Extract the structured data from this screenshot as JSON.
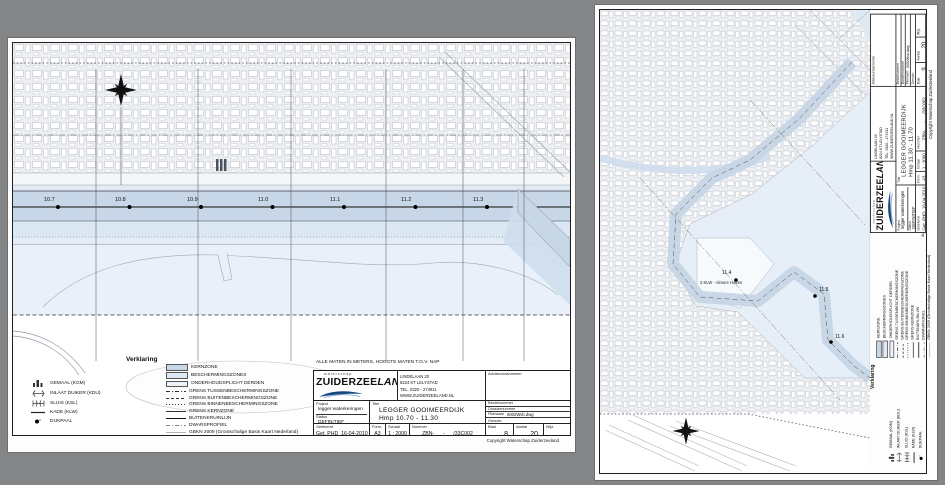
{
  "shared": {
    "note": "ALLE MATEN IN METERS, HOOGTE MATEN T.O.V. NAP",
    "copyright": "Copyright Waterschap Zuiderzeeland",
    "legend": {
      "title": "Verklaring",
      "symbols": [
        {
          "icon": "gemaal-icon",
          "label": "GEMAAL (KGM)"
        },
        {
          "icon": "inlaat-duiker-icon",
          "label": "INLAAT DUIKER (KDU)"
        },
        {
          "icon": "sluis-icon",
          "label": "SLUIS (KSL)"
        },
        {
          "icon": "kade-line-icon",
          "label": "KADE (KLW)"
        },
        {
          "icon": "dijkpaal-dot-icon",
          "label": "DIJKPAAL"
        }
      ],
      "zones": [
        {
          "label": "KERNZONE",
          "swatch": "#c8d7e7"
        },
        {
          "label": "BESCHERMINGSZONES",
          "swatch": "#dfe9f4"
        },
        {
          "label": "ONDERHOUDSPLICHT DERDEN",
          "swatch": "#eef3f9"
        },
        {
          "label": "GRENS TUSSENBESCHERMINGSZONE",
          "swatch": "dash-dot"
        },
        {
          "label": "GRENS BUITENBESCHERMINGSZONE",
          "swatch": "dashed"
        },
        {
          "label": "GRENS BINNENBESCHERMINGSZONE",
          "swatch": "dotted"
        },
        {
          "label": "GRENS KERNZONE",
          "swatch": "solid"
        },
        {
          "label": "BUITENKRUINLIJN",
          "swatch": "solid-thin"
        },
        {
          "label": "DWARSPROFIEL",
          "swatch": "dash-dot-gray"
        },
        {
          "label": "GBKN 2009 (Grootschalige Basis Kaart Nederland)",
          "swatch": "solid-gray"
        }
      ]
    },
    "company": {
      "tagline": "waterschap",
      "name_main": "ZUIDERZEE",
      "name_suffix": "LAND",
      "address": [
        "LINDELAAN 20",
        "8224 KT LELYSTAD",
        "TEL. 0320 - 274911",
        "WWW.ZUIDERZEELAND.NL"
      ]
    },
    "fields": {
      "adviseur_label": "Adviseur/aannemer",
      "project_label": "Project",
      "project_value": "legger waterkeringen",
      "status_label": "Status",
      "status_value": "DEFINITIEF",
      "titel_label": "Titel",
      "getekend_label": "Getekend",
      "getekend_value": "Get.  PHD",
      "date_value": "16-04-2010",
      "form_label": "Form.",
      "form_value": "A3",
      "schaal_label": "Schaal",
      "schaal_value": "1 : 2000",
      "nummer_label": "Nummer",
      "bestelnummer_label": "Bestelnummer",
      "dossiernummer_label": "Dossiernummer",
      "filenaam_label": "Filenaam",
      "filenaam_value": "0002Wvb.dwg",
      "omschr_label": "Omschr.",
      "blad_label": "Blad",
      "aantal_label": "Aantal",
      "aantal_value": "20",
      "wijz_label": "Wijz."
    },
    "colors": {
      "kernzone": "#c8d7e7",
      "beschermingszone": "#dfe9f4",
      "water": "#e9f0f9",
      "urban": "#edeff3",
      "logo_blue": "#16477e"
    }
  },
  "sheet_left": {
    "title_lines": [
      "LEGGER GOOIMEERDIJK",
      "Hmp 10.70 - 11.30",
      "KAARTBLAD ZBN-08"
    ],
    "nummer_value": "ZBN-      -      /33C002",
    "blad_value": "8",
    "dijkpalen": [
      "10.7",
      "10.8",
      "10.9",
      "11.0",
      "11.1",
      "11.2",
      "11.3"
    ]
  },
  "sheet_right": {
    "title_lines": [
      "LEGGER GOOIMEERDIJK",
      "Hmp 11.30 - 11.70",
      "KAARTBLAD ZBN-09"
    ],
    "nummer_value": "ZBN-      -      /33C002",
    "blad_value": "9",
    "harbor_label": "2 KLW - Almere Haven",
    "dijkpalen": [
      "11.4",
      "11.5",
      "11.6"
    ]
  }
}
